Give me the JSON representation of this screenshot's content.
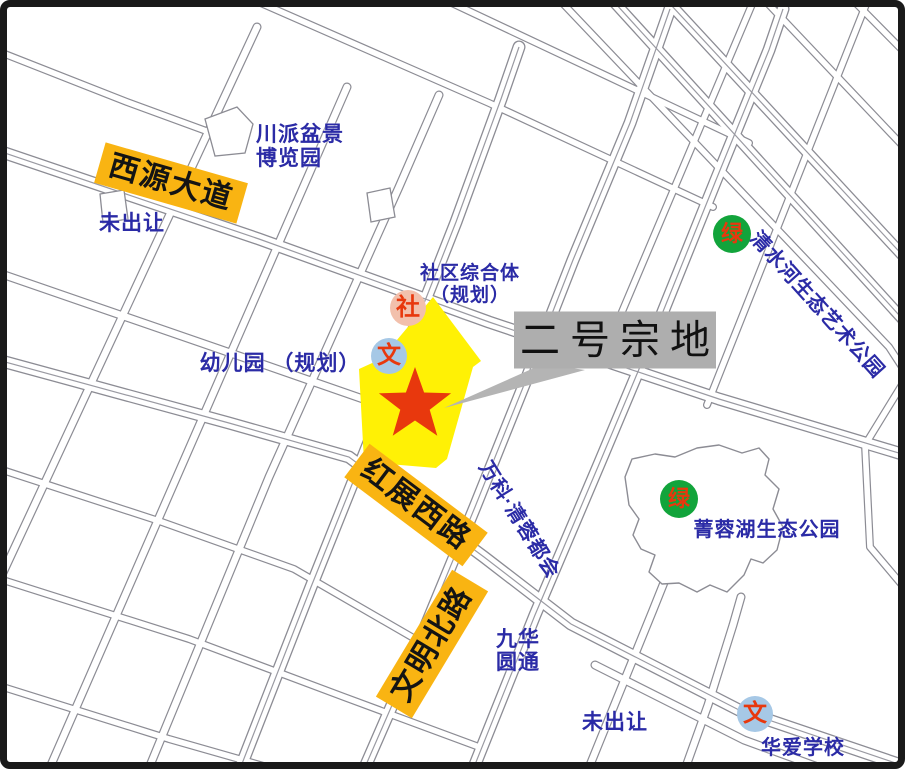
{
  "colors": {
    "label_yellow": "#F9B412",
    "parcel": "#FFF105",
    "star": "#E8380D",
    "blue_text": "#2B2BA6",
    "callout_box": "#AEAEAE",
    "callout_wedge": "#B4B4B4",
    "green_badge": "#12A43B",
    "pink_badge": "#F2C0AC",
    "lightblue_badge": "#A6C8E6",
    "road_line": "#8C8C94",
    "border": "#1A1A1A",
    "badge_text": "#E8380D",
    "title_text": "#111111"
  },
  "callout": {
    "title": "二号宗地"
  },
  "roads": {
    "xiyuan": "西源大道",
    "hongzhan": "红展西路",
    "wenming": "文明北路"
  },
  "places": {
    "chuanpai": {
      "line1": "川派盆景",
      "line2": "博览园"
    },
    "weichurang_nw": "未出让",
    "shequ": {
      "line1": "社区综合体",
      "line2": "（规划）"
    },
    "youeryuan": "幼儿园 （规划）",
    "wanke": "万科·清蓉都会",
    "qingshuihe": "清水河生态艺术公园",
    "jingronghu": "菁蓉湖生态公园",
    "jiuhua": {
      "line1": "九华",
      "line2": "圆通"
    },
    "weichurang_s": "未出让",
    "huaai": "华爱学校"
  },
  "badges": {
    "community": "社",
    "school_planned": "文",
    "green_top": "绿",
    "green_park": "绿",
    "school_huaai": "文"
  }
}
